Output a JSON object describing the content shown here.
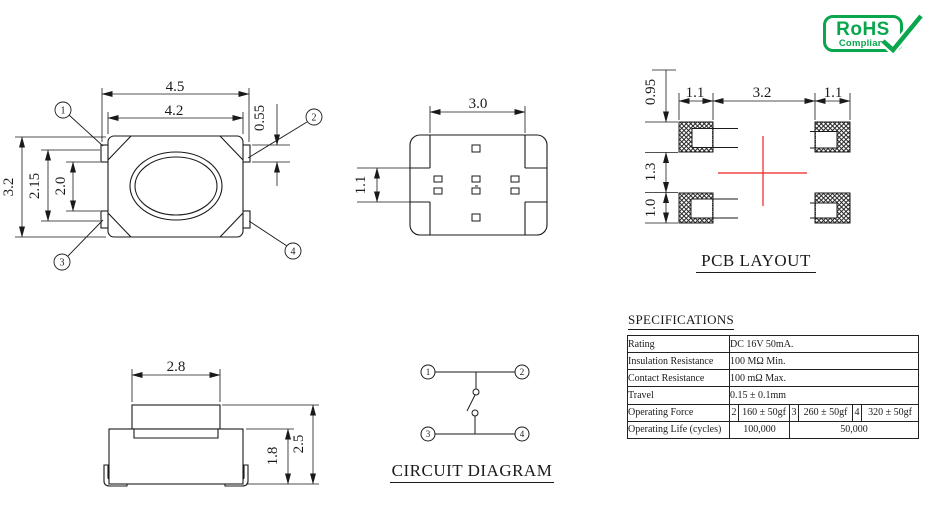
{
  "rohs": {
    "title": "RoHS",
    "subtitle": "Compliant"
  },
  "top_view": {
    "dims": {
      "overall_w": "4.5",
      "body_w": "4.2",
      "pin_len": "0.55",
      "overall_h": "3.2",
      "inner_h1": "2.15",
      "inner_h2": "2.0"
    },
    "pins": [
      "1",
      "2",
      "3",
      "4"
    ]
  },
  "bottom_view": {
    "dims": {
      "top_w": "3.0",
      "side_pitch": "1.1"
    }
  },
  "pcb_layout": {
    "title": "PCB LAYOUT",
    "dims": {
      "pad_h_top": "0.95",
      "pad_w_left": "1.1",
      "pad_gap": "3.2",
      "pad_w_right": "1.1",
      "row_gap": "1.3",
      "pad_h_bottom": "1.0"
    }
  },
  "front_view": {
    "dims": {
      "button_w": "2.8",
      "body_h": "1.8",
      "total_h": "2.5"
    }
  },
  "circuit": {
    "title": "CIRCUIT DIAGRAM",
    "pins": [
      "1",
      "2",
      "3",
      "4"
    ]
  },
  "specs": {
    "title": "SPECIFICATIONS",
    "rows": [
      {
        "label": "Rating",
        "value": "DC 16V 50mA."
      },
      {
        "label": "Insulation Resistance",
        "value": "100 MΩ Min."
      },
      {
        "label": "Contact Resistance",
        "value": "100 mΩ Max."
      },
      {
        "label": "Travel",
        "value": "0.15 ± 0.1mm"
      },
      {
        "label": "Operating Force",
        "cells": [
          "2",
          "160 ± 50gf",
          "3",
          "260 ± 50gf",
          "4",
          "320 ± 50gf"
        ]
      },
      {
        "label": "Operating Life (cycles)",
        "cells": [
          "100,000",
          "50,000"
        ]
      }
    ]
  },
  "colors": {
    "brand_green": "#0aa64e",
    "center_mark_red": "#ee2222",
    "line": "#1a1a1a"
  }
}
